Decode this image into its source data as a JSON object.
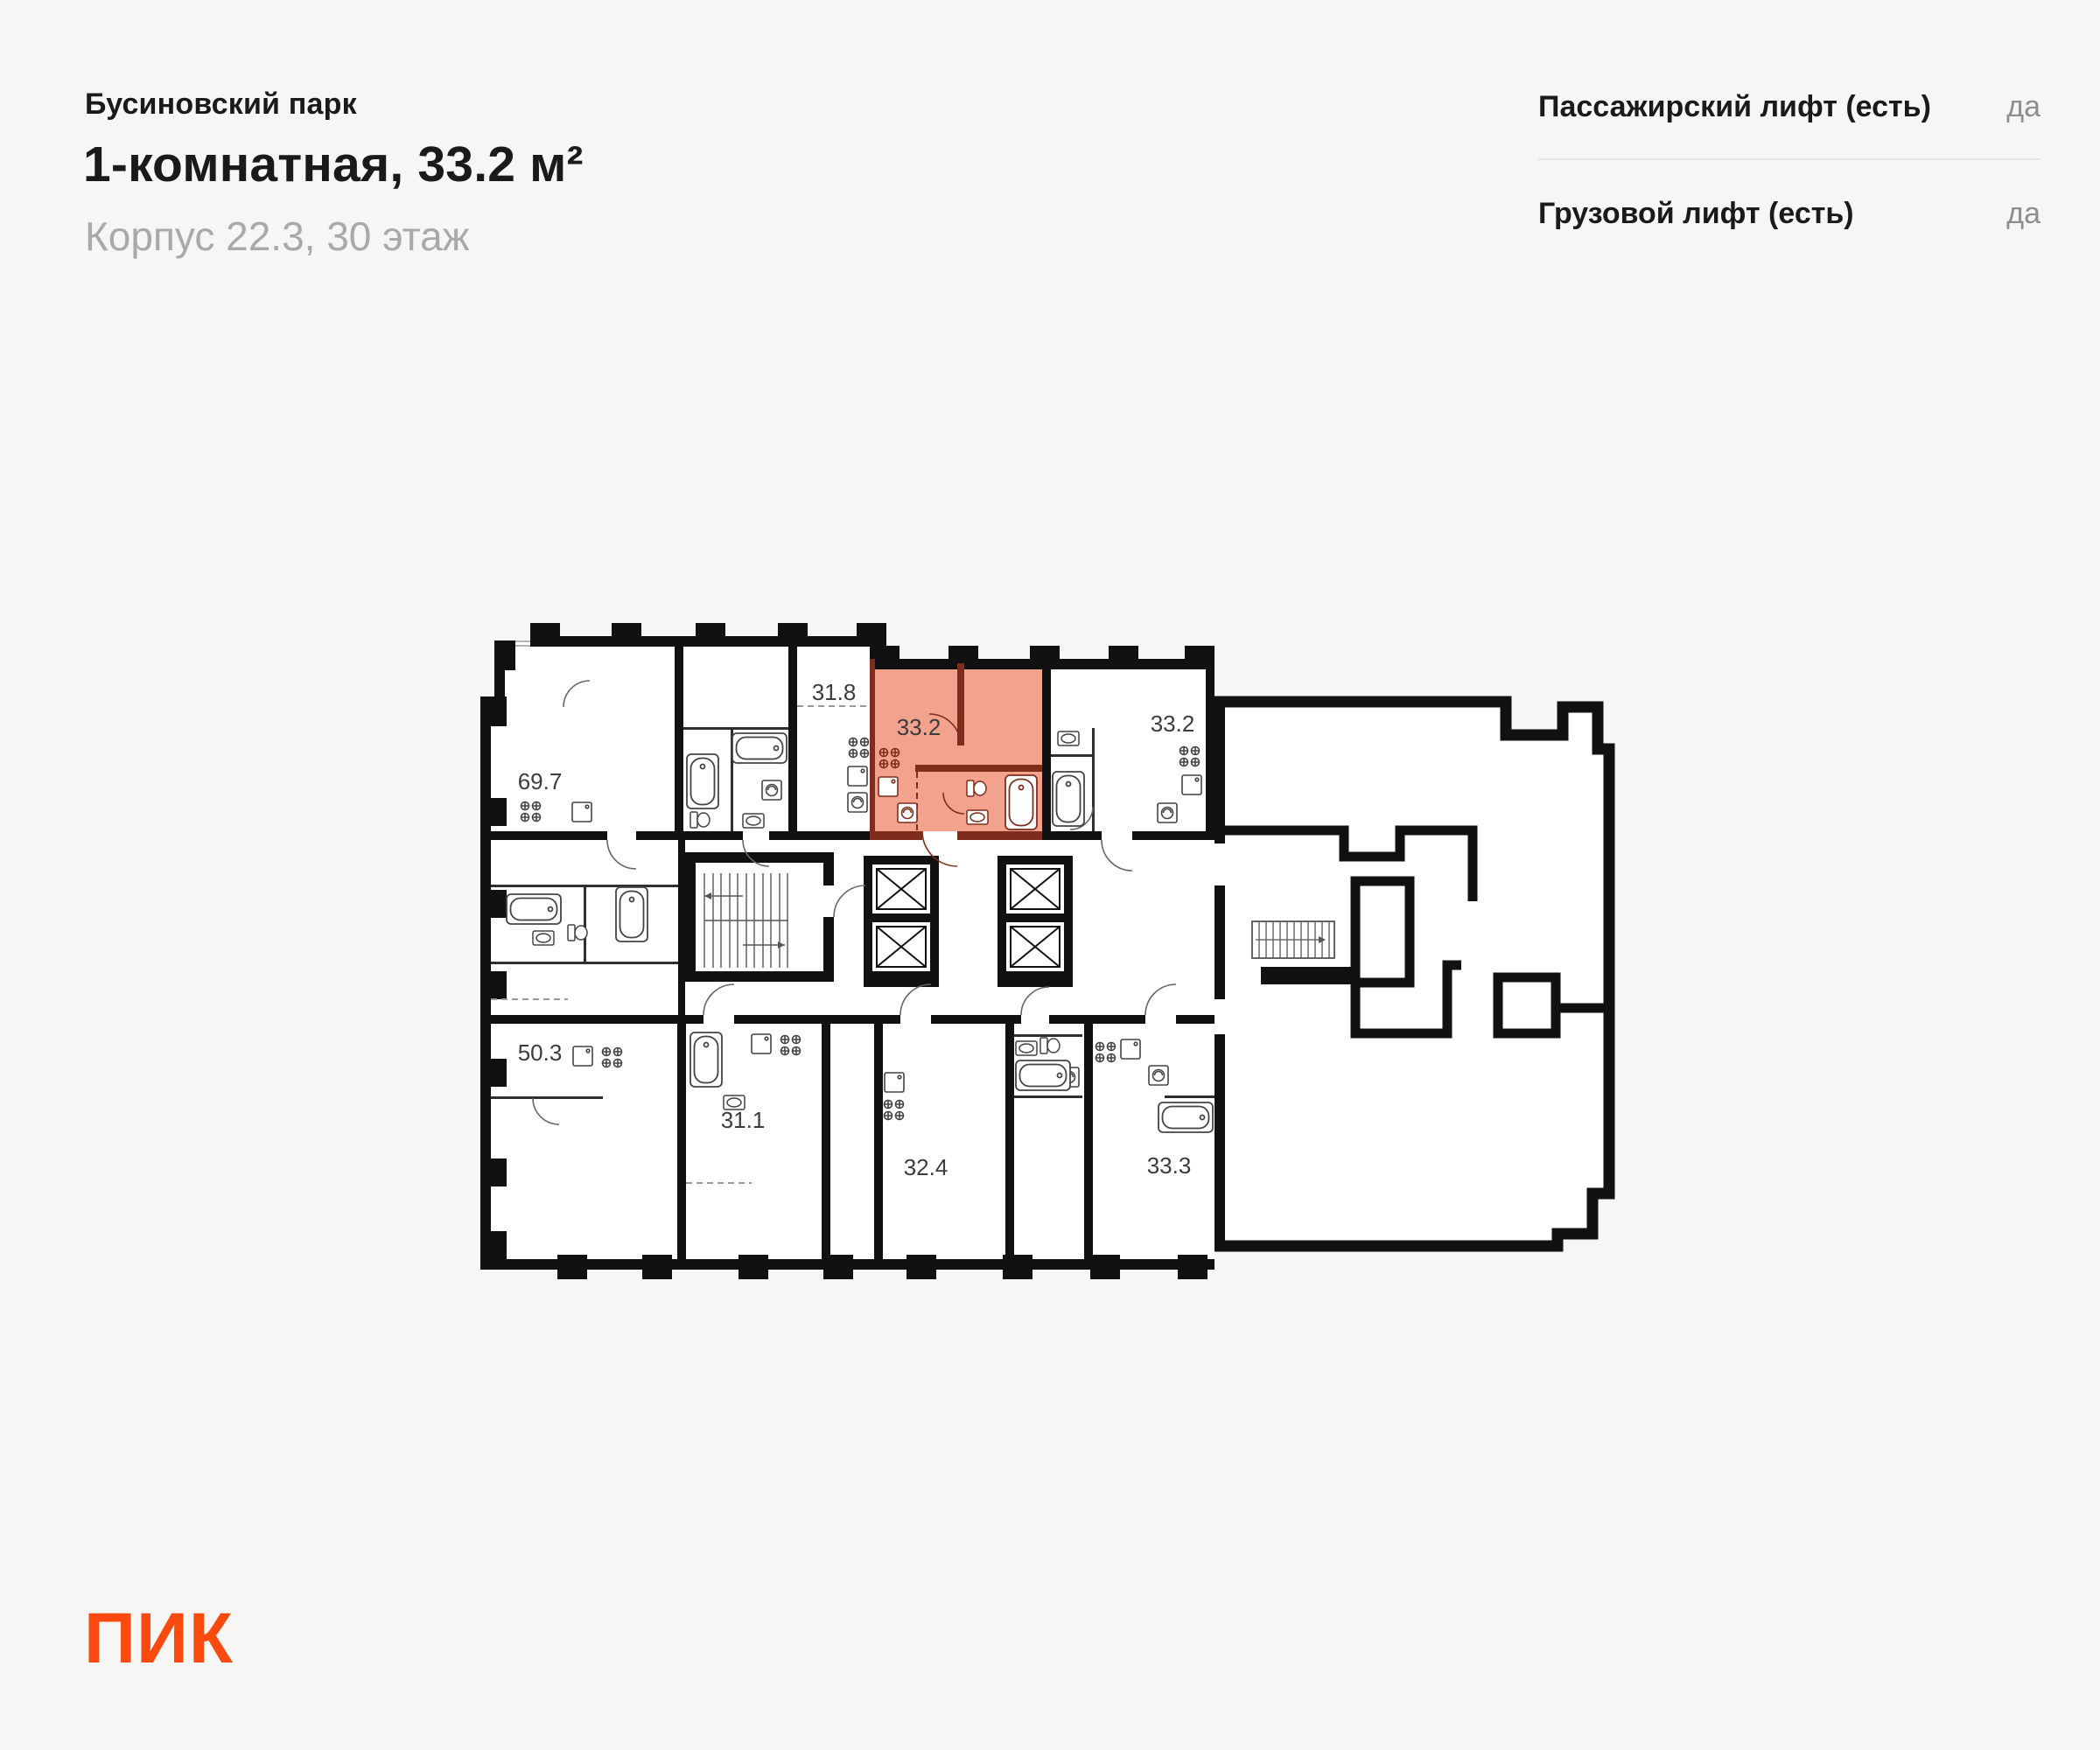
{
  "header": {
    "project": "Бусиновский парк",
    "title": "1-комнатная, 33.2 м²",
    "subtitle": "Корпус 22.3, 30 этаж"
  },
  "features": {
    "rows": [
      {
        "label": "Пассажирский лифт (есть)",
        "value": "да"
      },
      {
        "label": "Грузовой лифт (есть)",
        "value": "да"
      }
    ]
  },
  "plan": {
    "labels": {
      "a69_7": "69.7",
      "a31_8": "31.8",
      "a33_2_hl": "33.2",
      "a33_2": "33.2",
      "a50_3": "50.3",
      "a31_1": "31.1",
      "a32_4": "32.4",
      "a33_3": "33.3"
    },
    "colors": {
      "wall": "#111111",
      "highlight_fill": "#F3A28D",
      "highlight_wall": "#7E2D1C"
    }
  },
  "logo": {
    "text": "ПИК",
    "color": "#FB4A0F"
  }
}
